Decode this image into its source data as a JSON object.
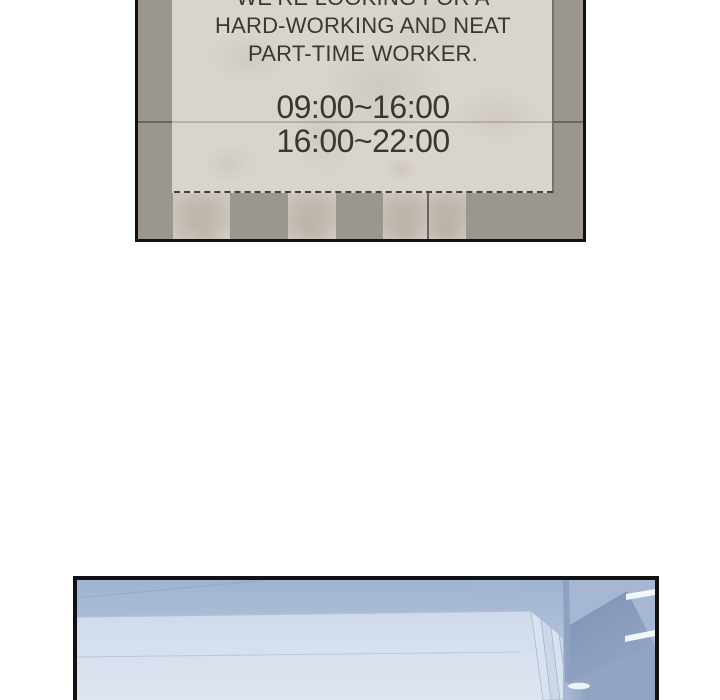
{
  "colors": {
    "page-bg": "#ffffff",
    "panel-border": "#111111",
    "wall": "#9b9690",
    "wall-seam": "#6a655f",
    "paper": "#d9d5ce",
    "paper-edge": "#76726c",
    "sign-text": "#3a3733",
    "tear-dash": "#45413d",
    "scene-sky-top": "#9fb3d1",
    "scene-sky-bottom": "#c3d0e2",
    "surface-top": "#cfdaea",
    "surface-bottom": "#dfe6f1",
    "surface-edge": "#b0c0d6",
    "slab-light": "#d9e2ef",
    "slab-mid": "#ccd8e9",
    "beam-dark": "#7e92b6",
    "beam-light": "#94a6c4",
    "right-wall": "#a6b7d3",
    "lower-wall": "#92a4c2",
    "pole": "#8fa1c0",
    "light-stripe": "#f3f6fa",
    "cylinder-dark": "#8ba0bf",
    "cylinder-light": "#a7b7d1",
    "cylinder-rim": "#eef3f8"
  },
  "panel_top": {
    "sign": {
      "line1": "WE’RE LOOKING FOR A",
      "line2": "HARD-WORKING AND NEAT",
      "line3": "PART-TIME WORKER.",
      "shift1": "09:00~16:00",
      "shift2": "16:00~22:00"
    },
    "tabs_remaining": 4
  },
  "panel_bottom": {
    "description": "store interior in blue tones"
  }
}
